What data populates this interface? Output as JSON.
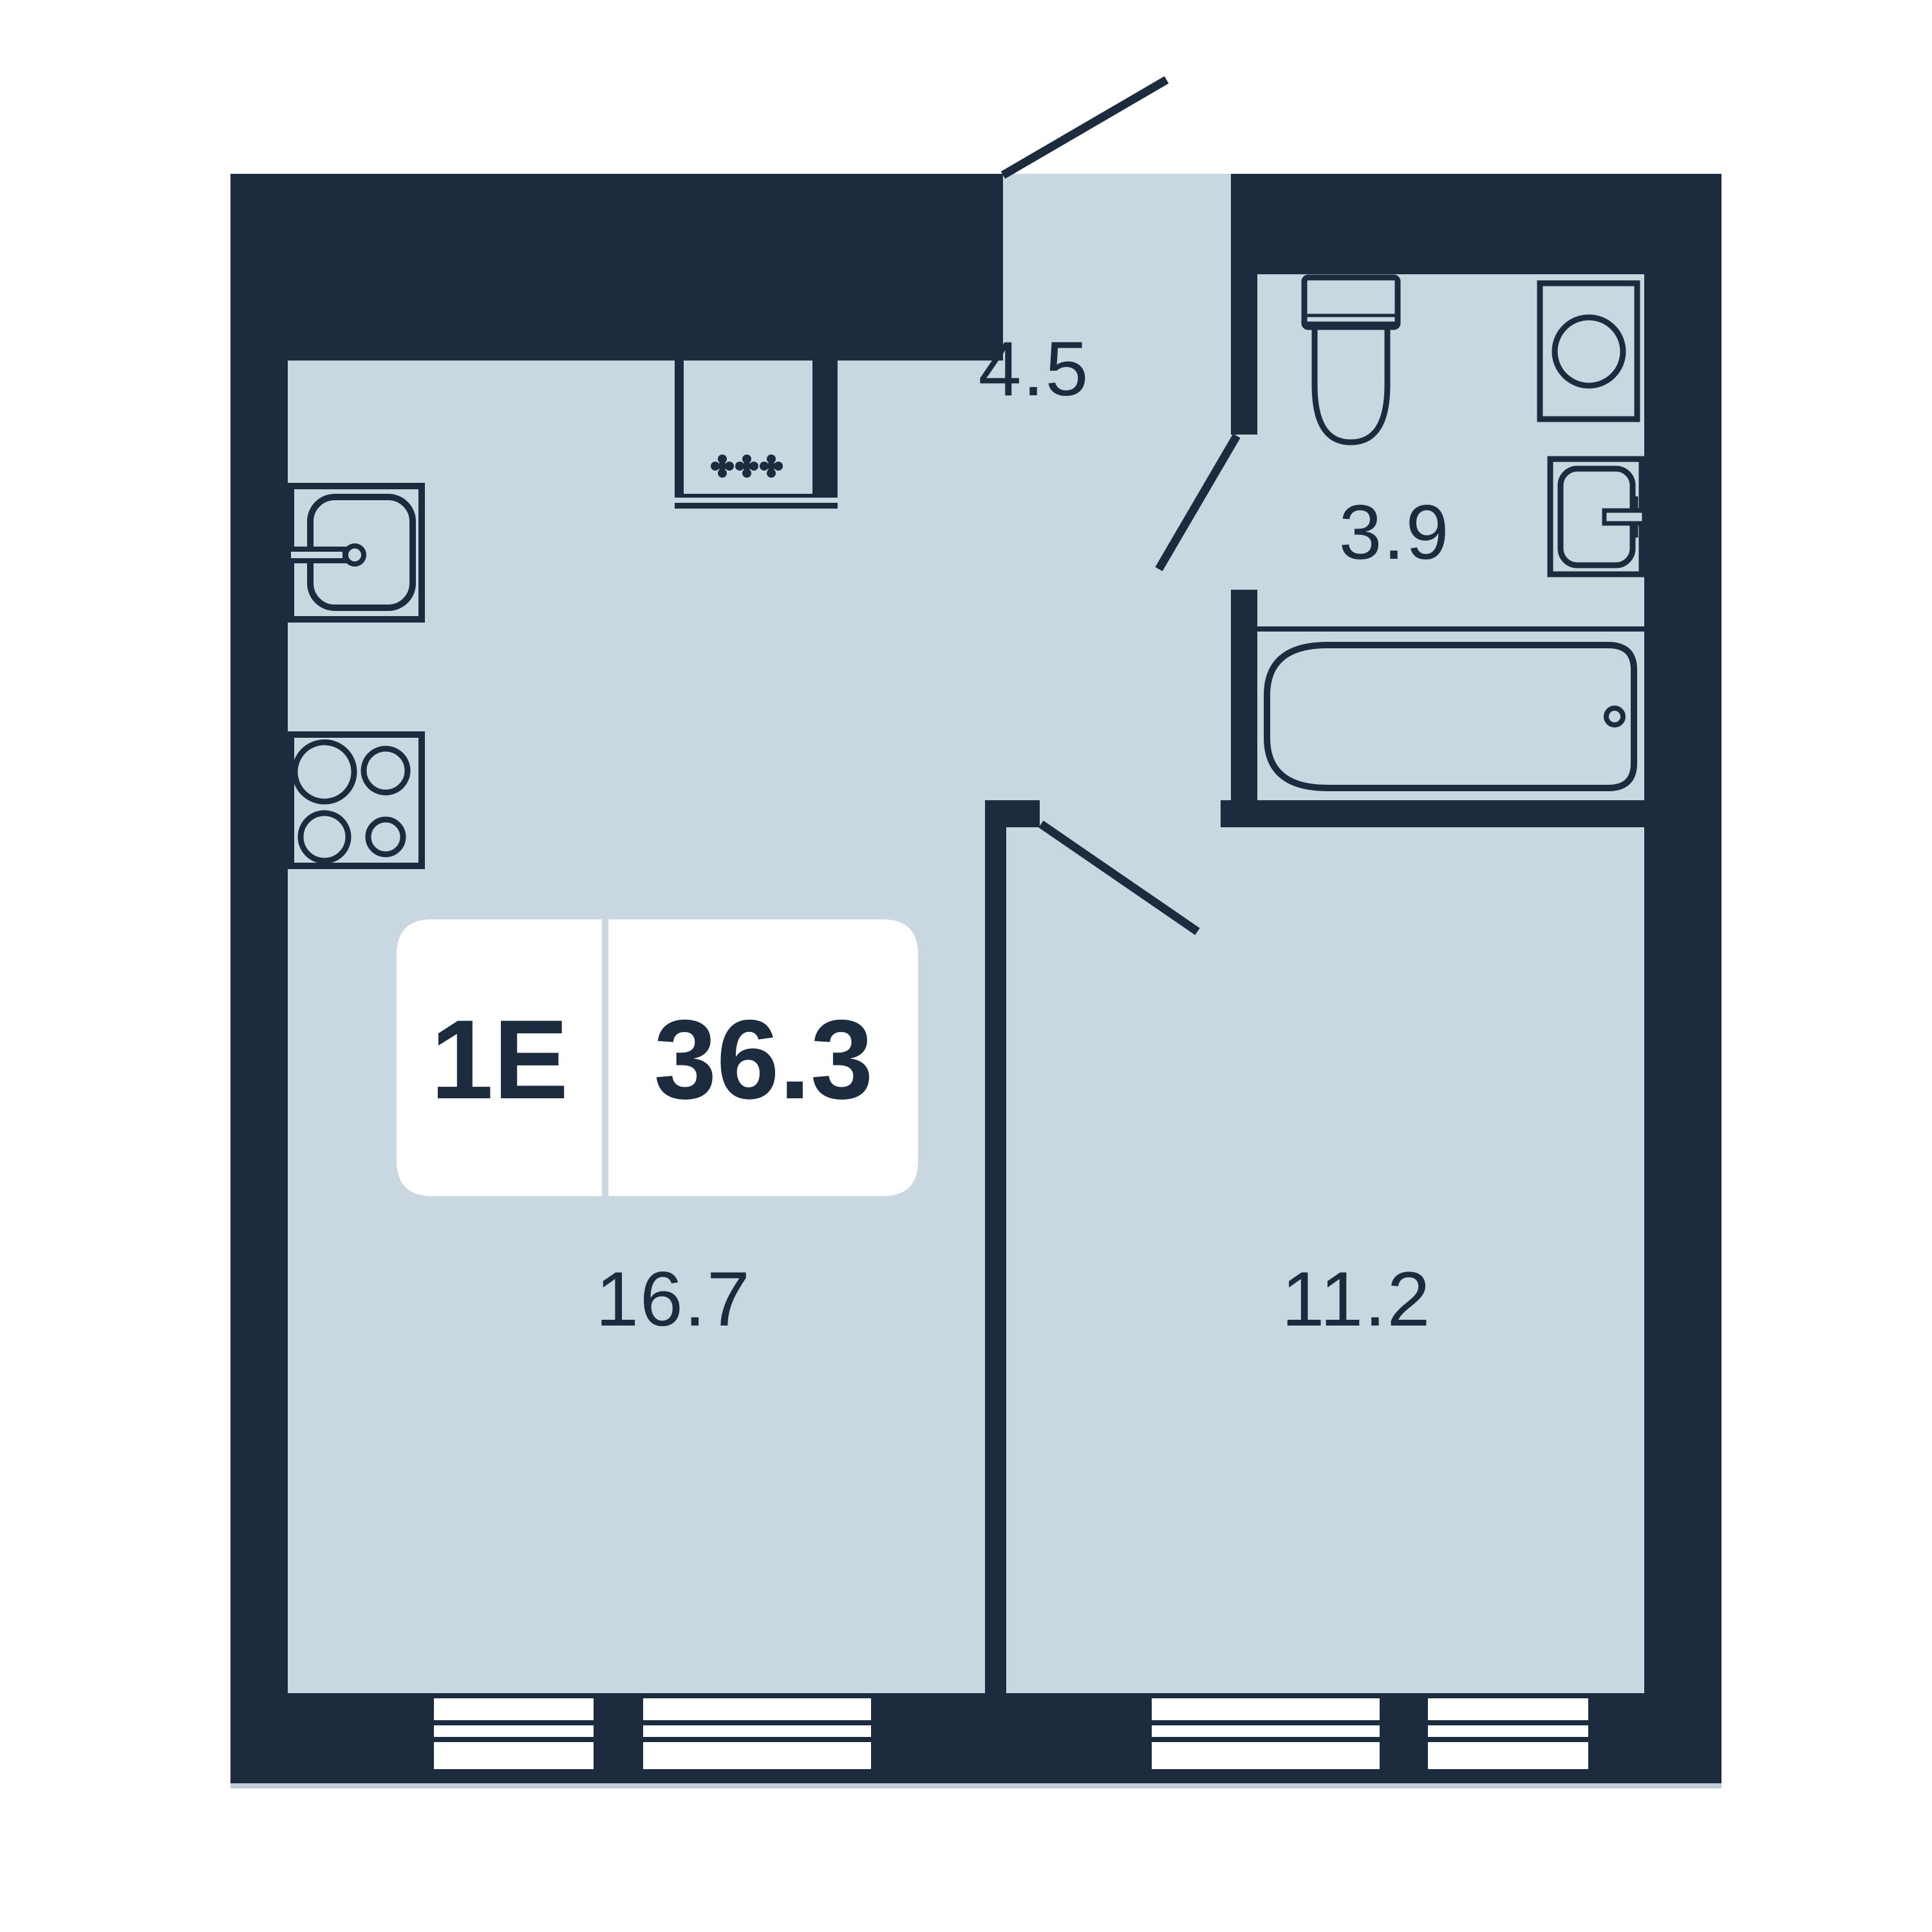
{
  "floorplan": {
    "unit_badge": {
      "type": "1E",
      "total_area": "36.3"
    },
    "rooms": [
      {
        "id": "hallway",
        "area_label": "4.5"
      },
      {
        "id": "bathroom",
        "area_label": "3.9"
      },
      {
        "id": "kitchen_living",
        "area_label": "16.7"
      },
      {
        "id": "bedroom",
        "area_label": "11.2"
      }
    ],
    "colors": {
      "wall": "#1C2B3E",
      "floor": "#C8D7E0",
      "background": "#FFFFFF",
      "badge_background": "#FFFFFF",
      "shadow_line": "#C3CCD8"
    }
  }
}
